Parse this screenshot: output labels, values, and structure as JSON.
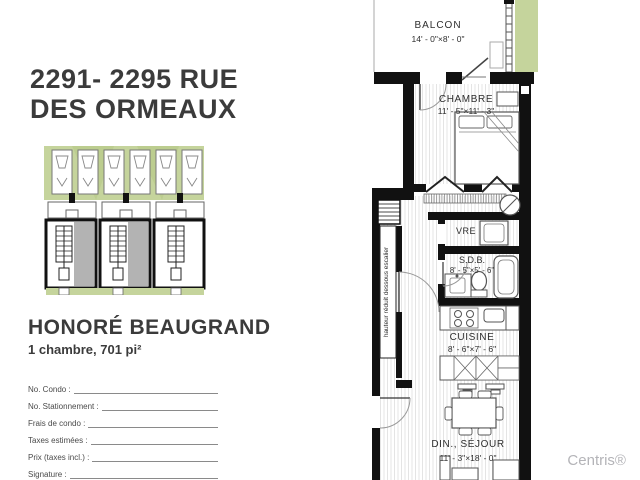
{
  "listing": {
    "title_line1": "2291- 2295 RUE",
    "title_line2": "DES ORMEAUX",
    "model_name": "HONORÉ BEAUGRAND",
    "unit_summary": "1 chambre, 701 pi²",
    "watermark": "Centris®"
  },
  "form": {
    "fields": [
      {
        "label": "No. Condo :"
      },
      {
        "label": "No. Stationnement :"
      },
      {
        "label": "Frais de condo :"
      },
      {
        "label": "Taxes estimées :"
      },
      {
        "label": "Prix (taxes incl.) :"
      },
      {
        "label": "Signature :"
      }
    ]
  },
  "floor_plan": {
    "balcony_name": "BALCON",
    "balcony_dims": "14' - 0\"×8' - 0\"",
    "bedroom_name": "CHAMBRE",
    "bedroom_dims": "11' - 5\"×11' - 3\"",
    "closet_name": "VRE",
    "bath_name": "S.D.B.",
    "bath_dims": "8' - 5\"×5' - 6\"",
    "kitchen_name": "CUISINE",
    "kitchen_dims": "8' - 6\"×7' - 6\"",
    "living_name": "DIN., SÉJOUR",
    "living_dims": "11' - 3\"×18' - 0\"",
    "stair_note": "hauteur réduit dessous escalier"
  },
  "colors": {
    "landscape_green": "#c5d49c",
    "landscape_green_dark": "#b4c785",
    "site_gray": "#b3b3b3",
    "wall_black": "#111111",
    "title_gray": "#3b3b3b",
    "watermark_gray": "#b4b4b8"
  }
}
